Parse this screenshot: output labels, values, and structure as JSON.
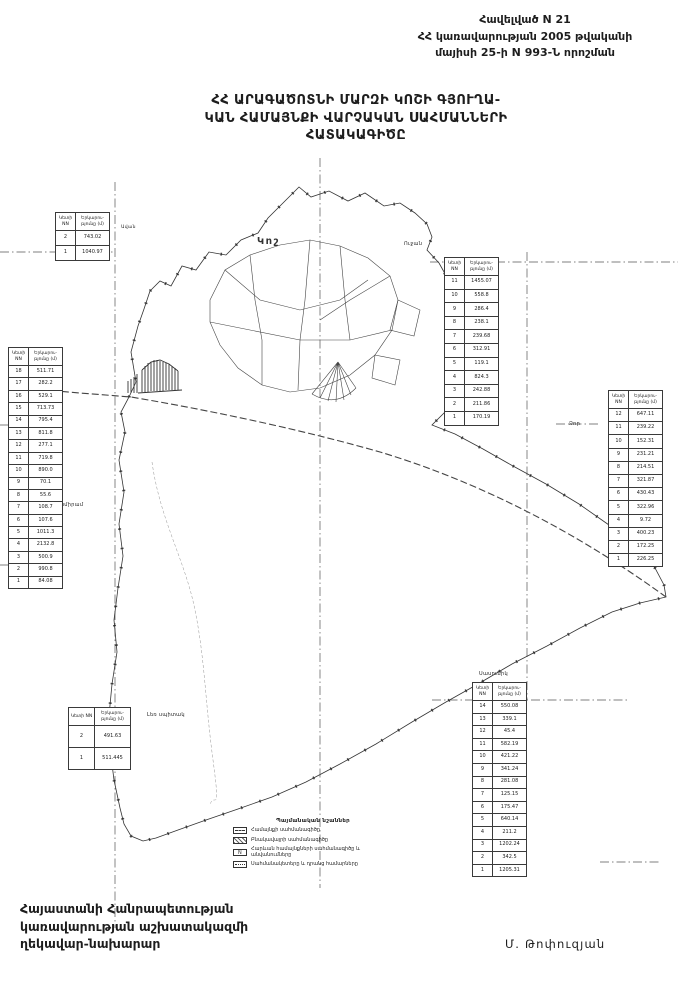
{
  "header": {
    "line1": "Հավելված N 21",
    "line2": "ՀՀ կառավարության 2005 թվականի",
    "line3": "մայիսի 25-ի N 993-Ն որոշման"
  },
  "title": {
    "line1": "ՀՀ ԱՐԱԳԱԾՈՏՆԻ ՄԱՐԶԻ ԿՈՇԻ ԳՅՈՒՂԱ-",
    "line2": "ԿԱՆ ՀԱՄԱՅՆՔԻ ՎԱՐՉԱԿԱՆ ՍԱՀՄԱՆՆԵՐԻ",
    "line3": "ՀԱՏԱԿԱԳԻԾԸ"
  },
  "map": {
    "labels": {
      "center": "Կոշ",
      "northeast": "Ուջան",
      "west": "Շամիրամ",
      "east": "Ձոր",
      "northwest": "Ավան"
    }
  },
  "tables": {
    "headers": {
      "col1": "Կետի NN",
      "col2": "Երկարու- թյունը (մ)"
    },
    "top_left": {
      "rows": [
        [
          "2",
          "743.02"
        ],
        [
          "1",
          "1040.97"
        ]
      ]
    },
    "left": {
      "rows": [
        [
          "18",
          "511.71"
        ],
        [
          "17",
          "282.2"
        ],
        [
          "16",
          "529.1"
        ],
        [
          "15",
          "713.73"
        ],
        [
          "14",
          "795.4"
        ],
        [
          "13",
          "811.8"
        ],
        [
          "12",
          "277.1"
        ],
        [
          "11",
          "719.8"
        ],
        [
          "10",
          "890.0"
        ],
        [
          "9",
          "70.1"
        ],
        [
          "8",
          "55.6"
        ],
        [
          "7",
          "108.7"
        ],
        [
          "6",
          "107.6"
        ],
        [
          "5",
          "1011.3"
        ],
        [
          "4",
          "2132.8"
        ],
        [
          "3",
          "500.9"
        ],
        [
          "2",
          "990.8"
        ],
        [
          "1",
          "84.08"
        ]
      ]
    },
    "right_top": {
      "rows": [
        [
          "11",
          "1455.07"
        ],
        [
          "10",
          "558.8"
        ],
        [
          "9",
          "286.4"
        ],
        [
          "8",
          "238.1"
        ],
        [
          "7",
          "239.68"
        ],
        [
          "6",
          "312.91"
        ],
        [
          "5",
          "119.1"
        ],
        [
          "4",
          "824.3"
        ],
        [
          "3",
          "242.88"
        ],
        [
          "2",
          "211.86"
        ],
        [
          "1",
          "170.19"
        ]
      ]
    },
    "right_mid": {
      "rows": [
        [
          "12",
          "647.11"
        ],
        [
          "11",
          "239.22"
        ],
        [
          "10",
          "152.31"
        ],
        [
          "9",
          "231.21"
        ],
        [
          "8",
          "214.51"
        ],
        [
          "7",
          "321.87"
        ],
        [
          "6",
          "430.43"
        ],
        [
          "5",
          "322.96"
        ],
        [
          "4",
          "9.72"
        ],
        [
          "3",
          "400.23"
        ],
        [
          "2",
          "172.25"
        ],
        [
          "1",
          "226.25"
        ]
      ]
    },
    "bottom_right": {
      "caption": "Սասունիկ",
      "rows": [
        [
          "14",
          "550.08"
        ],
        [
          "13",
          "339.1"
        ],
        [
          "12",
          "45.4"
        ],
        [
          "11",
          "582.19"
        ],
        [
          "10",
          "421.22"
        ],
        [
          "9",
          "341.24"
        ],
        [
          "8",
          "281.08"
        ],
        [
          "7",
          "125.15"
        ],
        [
          "6",
          "175.47"
        ],
        [
          "5",
          "640.14"
        ],
        [
          "4",
          "211.2"
        ],
        [
          "3",
          "1202.24"
        ],
        [
          "2",
          "342.5"
        ],
        [
          "1",
          "1205.31"
        ]
      ]
    },
    "bottom_left": {
      "caption": "Լեռ սպիտակ",
      "rows": [
        [
          "2",
          "491.63"
        ],
        [
          "1",
          "511.445"
        ]
      ]
    }
  },
  "legend": {
    "title": "Պայմանական նշաններ",
    "items": [
      {
        "swatch": "dashline",
        "label": "Համայնքի սահմանագիծը"
      },
      {
        "swatch": "hatch",
        "label": "Բնակավայրի սահմանագիծը"
      },
      {
        "swatch": "marker",
        "label": "Հարևան համայնքների սահմանագիծը և անվանումները"
      },
      {
        "swatch": "dots",
        "label": "Սահմանակետերը և դրանց համարները"
      }
    ]
  },
  "footer": {
    "left_line1": "Հայաստանի Հանրապետության",
    "left_line2": "կառավարության աշխատակազմի",
    "left_line3": "ղեկավար-նախարար",
    "signature": "Մ. Թոփուզյան"
  }
}
